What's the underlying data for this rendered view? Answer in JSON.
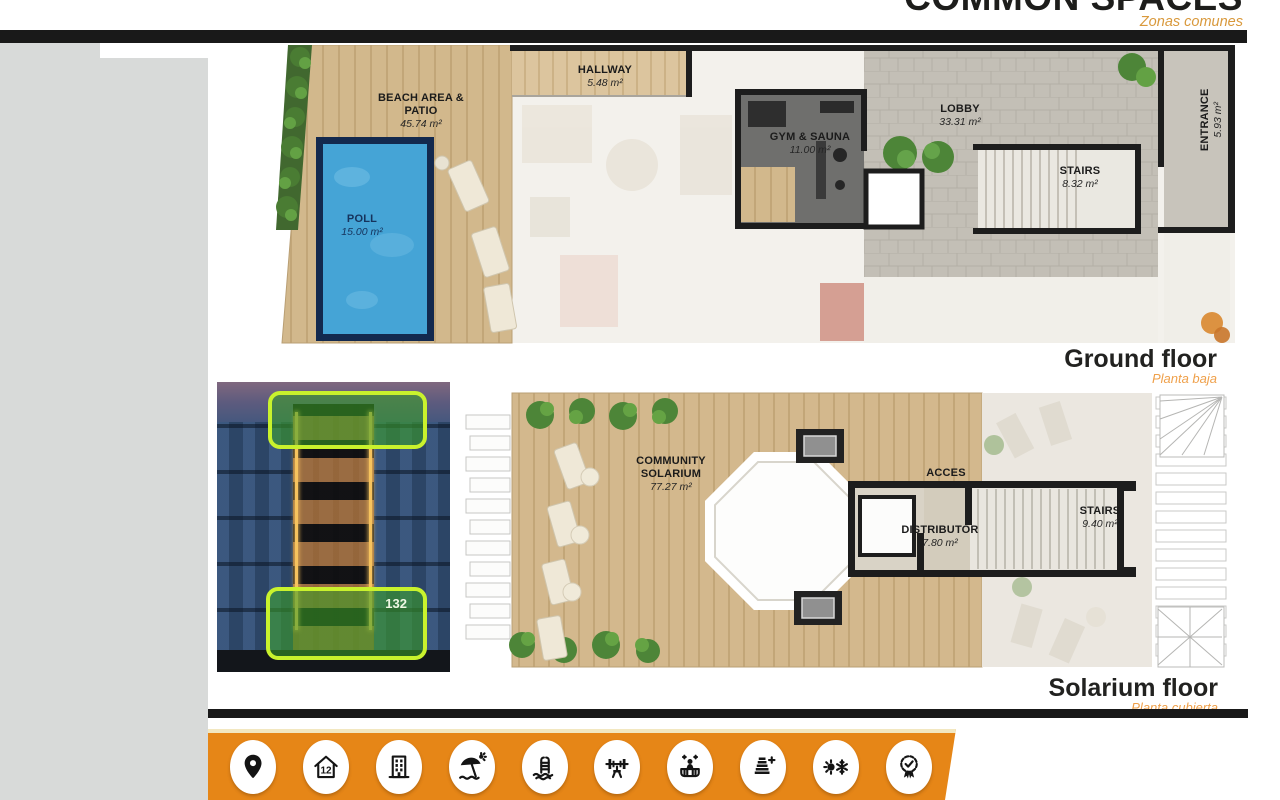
{
  "header": {
    "title": "COMMON SPACES",
    "subtitle": "Zonas comunes"
  },
  "ground_floor": {
    "label": "Ground floor",
    "sublabel": "Planta baja",
    "rooms": [
      {
        "name": "BEACH AREA & PATIO",
        "area": "45.74 m²"
      },
      {
        "name": "POLL",
        "area": "15.00 m²"
      },
      {
        "name": "HALLWAY",
        "area": "5.48 m²"
      },
      {
        "name": "GYM & SAUNA",
        "area": "11.00 m²"
      },
      {
        "name": "LOBBY",
        "area": "33.31 m²"
      },
      {
        "name": "STAIRS",
        "area": "8.32 m²"
      },
      {
        "name": "ENTRANCE",
        "area": "5.93 m²"
      }
    ]
  },
  "solarium_floor": {
    "label": "Solarium floor",
    "sublabel": "Planta cubierta",
    "rooms": [
      {
        "name": "COMMUNITY SOLARIUM",
        "area": "77.27 m²"
      },
      {
        "name": "ACCES",
        "area": ""
      },
      {
        "name": "DISTRIBUTOR",
        "area": "7.80 m²"
      },
      {
        "name": "STAIRS",
        "area": "9.40 m²"
      }
    ]
  },
  "building_photo": {
    "highlight_number": "132"
  },
  "footer": {
    "icons": [
      {
        "name": "location-pin"
      },
      {
        "name": "house-12",
        "label": "12"
      },
      {
        "name": "apartment-building"
      },
      {
        "name": "beach-umbrella"
      },
      {
        "name": "swimming-pool-ladder"
      },
      {
        "name": "gym-bench-press"
      },
      {
        "name": "jacuzzi"
      },
      {
        "name": "energy-rating"
      },
      {
        "name": "climate-control"
      },
      {
        "name": "quality-award"
      }
    ]
  },
  "colors": {
    "accent_orange": "#E68617",
    "subtitle_orange": "#D9993C",
    "floor_sub_orange": "#EFA04A",
    "bar_black": "#191919",
    "left_column_gray": "#D8DAD9",
    "highlight_green_border": "#C9F22D",
    "highlight_green_fill": "#3A9E26",
    "pool_blue": "#45A4D6",
    "deck_wood": "#D2B88C"
  }
}
